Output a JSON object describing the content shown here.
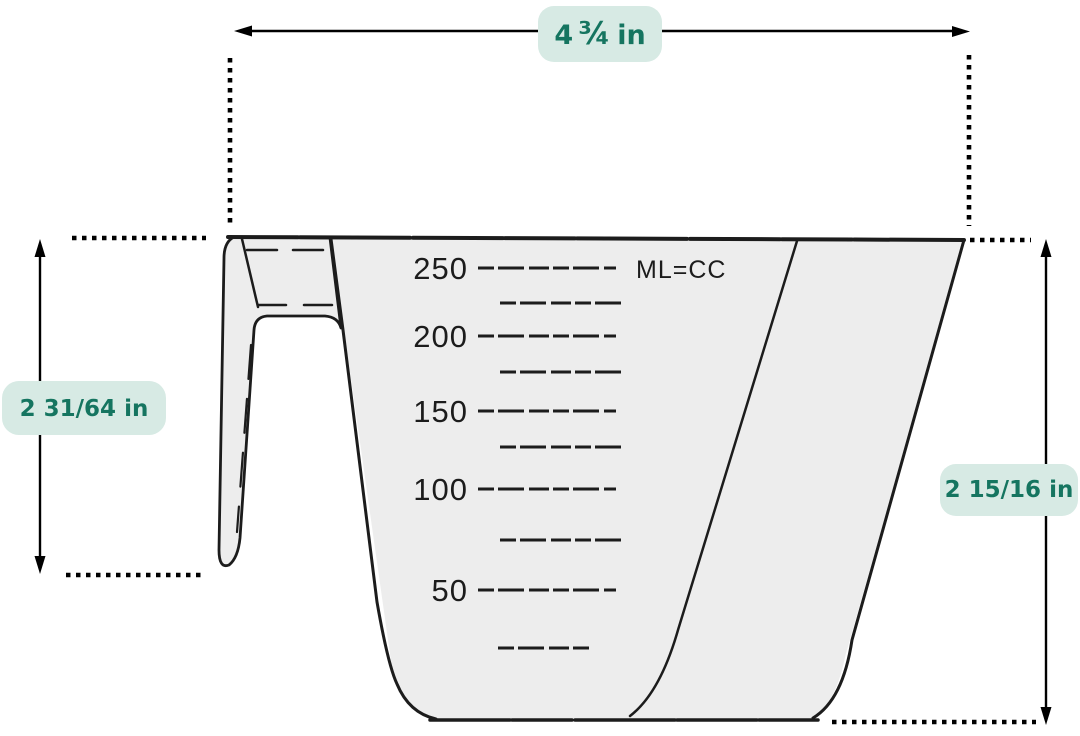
{
  "dimensions": {
    "top_width": {
      "whole": "4",
      "fraction": "¾",
      "unit": "in"
    },
    "handle_height": {
      "label": "2 31/64 in"
    },
    "cup_height": {
      "label": "2 15/16 in"
    }
  },
  "cup": {
    "unit_label": "ML=CC",
    "scale_labels": [
      "250",
      "200",
      "150",
      "100",
      "50"
    ]
  },
  "colors": {
    "badge_bg": "#d7eae4",
    "badge_text": "#157560",
    "ink": "#1c1c1c",
    "cup_fill": "#ededed",
    "dimension_line": "#000000"
  }
}
